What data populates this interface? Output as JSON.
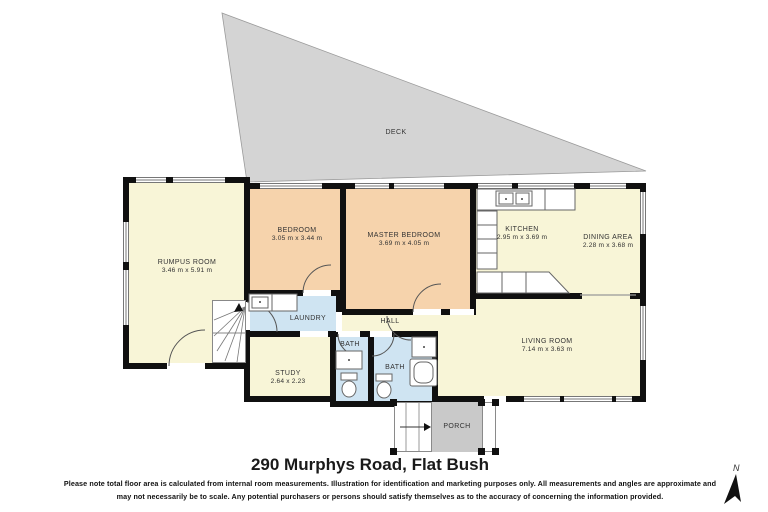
{
  "title": "290 Murphys Road, Flat Bush",
  "disclaimer": {
    "line1": "Please note total floor area is calculated from internal room measurements.  Illustration for identification and marketing purposes only.  All measurements and angles are approximate and",
    "line2": "may not necessarily be to scale.  Any potential purchasers or persons should satisfy themselves as to the accuracy of concerning the information provided."
  },
  "compass": {
    "label": "N"
  },
  "rooms": {
    "deck": {
      "name": "DECK"
    },
    "rumpus": {
      "name": "RUMPUS ROOM",
      "dims": "3.46 m x 5.91 m"
    },
    "bedroom": {
      "name": "BEDROOM",
      "dims": "3.05 m x 3.44 m"
    },
    "master": {
      "name": "MASTER BEDROOM",
      "dims": "3.69 m x 4.05 m"
    },
    "kitchen": {
      "name": "KITCHEN",
      "dims": "2.95 m x 3.69 m"
    },
    "dining": {
      "name": "DINING AREA",
      "dims": "2.28 m x 3.68 m"
    },
    "laundry": {
      "name": "LAUNDRY"
    },
    "hall": {
      "name": "HALL"
    },
    "study": {
      "name": "STUDY",
      "dims": "2.64 x 2.23"
    },
    "bath1": {
      "name": "BATH"
    },
    "bath2": {
      "name": "BATH"
    },
    "living": {
      "name": "LIVING ROOM",
      "dims": "7.14 m x 3.63 m"
    },
    "porch": {
      "name": "PORCH"
    }
  },
  "colors": {
    "room_cream": "#f8f5d7",
    "room_peach": "#f6d3ac",
    "room_wet_blue": "#cfe4f2",
    "deck_gray": "#d4d4d4",
    "porch_gray": "#c9c9c9",
    "wall_black": "#101010"
  }
}
